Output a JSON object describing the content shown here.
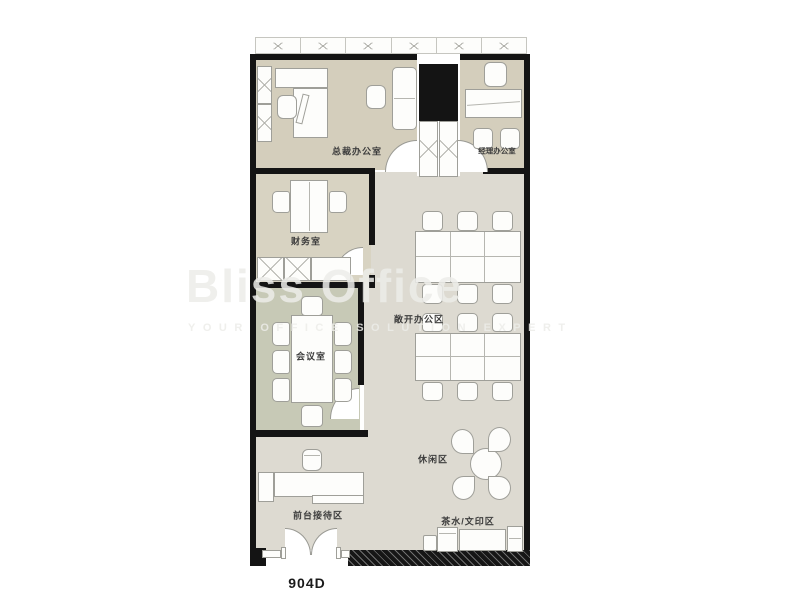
{
  "plan_code": "904D",
  "watermark": {
    "brand": "Bliss Office",
    "tagline": "YOUR OFFICE SOLUTION EXPERT"
  },
  "rooms": {
    "ceo_office": "总裁办公室",
    "manager_office": "经理办公室",
    "finance_room": "财务室",
    "meeting_room": "会议室",
    "open_office": "敞开办公区",
    "lounge": "休闲区",
    "tea_print": "茶水/文印区",
    "reception": "前台接待区"
  },
  "palette": {
    "wall": "#141414",
    "floor_warm": "#d4cebc",
    "floor_finance": "#d8d3c2",
    "floor_green": "#c7c9b6",
    "floor_gray": "#dddad1",
    "line": "#9f9f99",
    "furniture": "#fdfdfb",
    "watermark": "rgba(236,236,233,0.85)",
    "label": "#3c3c3c"
  }
}
